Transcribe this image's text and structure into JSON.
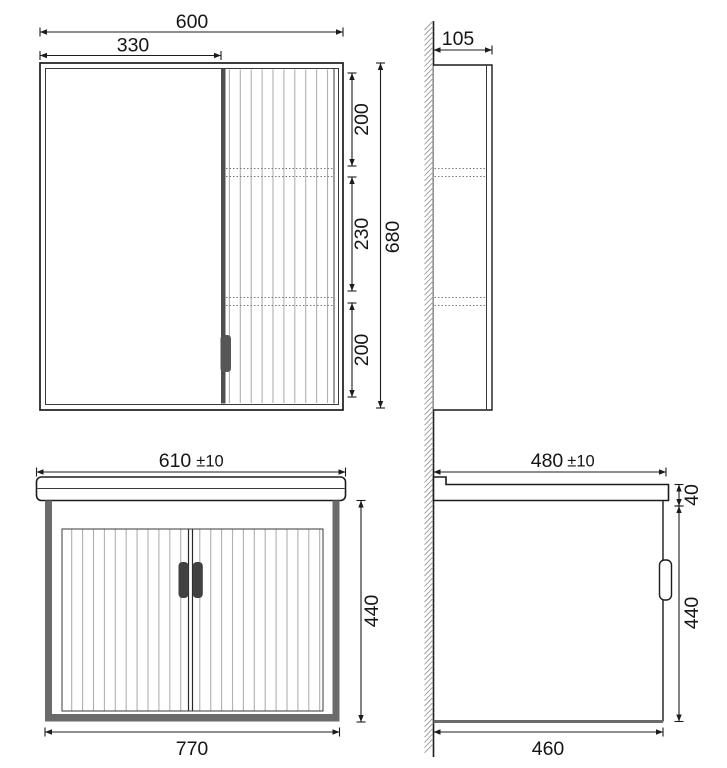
{
  "drawing": {
    "views": {
      "mirror_cabinet_front": {
        "overall_width": "600",
        "door_width": "330",
        "shelf_spacing_top": "200",
        "shelf_spacing_middle": "230",
        "shelf_spacing_bottom": "200",
        "overall_height": "680"
      },
      "mirror_cabinet_side": {
        "depth": "105"
      },
      "vanity_front": {
        "top_width_value": "610",
        "top_width_tolerance": "±10",
        "bottom_width": "770",
        "height": "440"
      },
      "vanity_side": {
        "depth_value": "480",
        "depth_tolerance": "±10",
        "countertop_height": "40",
        "body_height": "440",
        "bottom_depth": "460"
      }
    },
    "colors": {
      "line": "#1c1c1c",
      "slat_gray": "#b0b0b0",
      "frame_gray": "#6b6b6b",
      "handle_gray": "#4f4f4f",
      "background": "#ffffff"
    }
  }
}
